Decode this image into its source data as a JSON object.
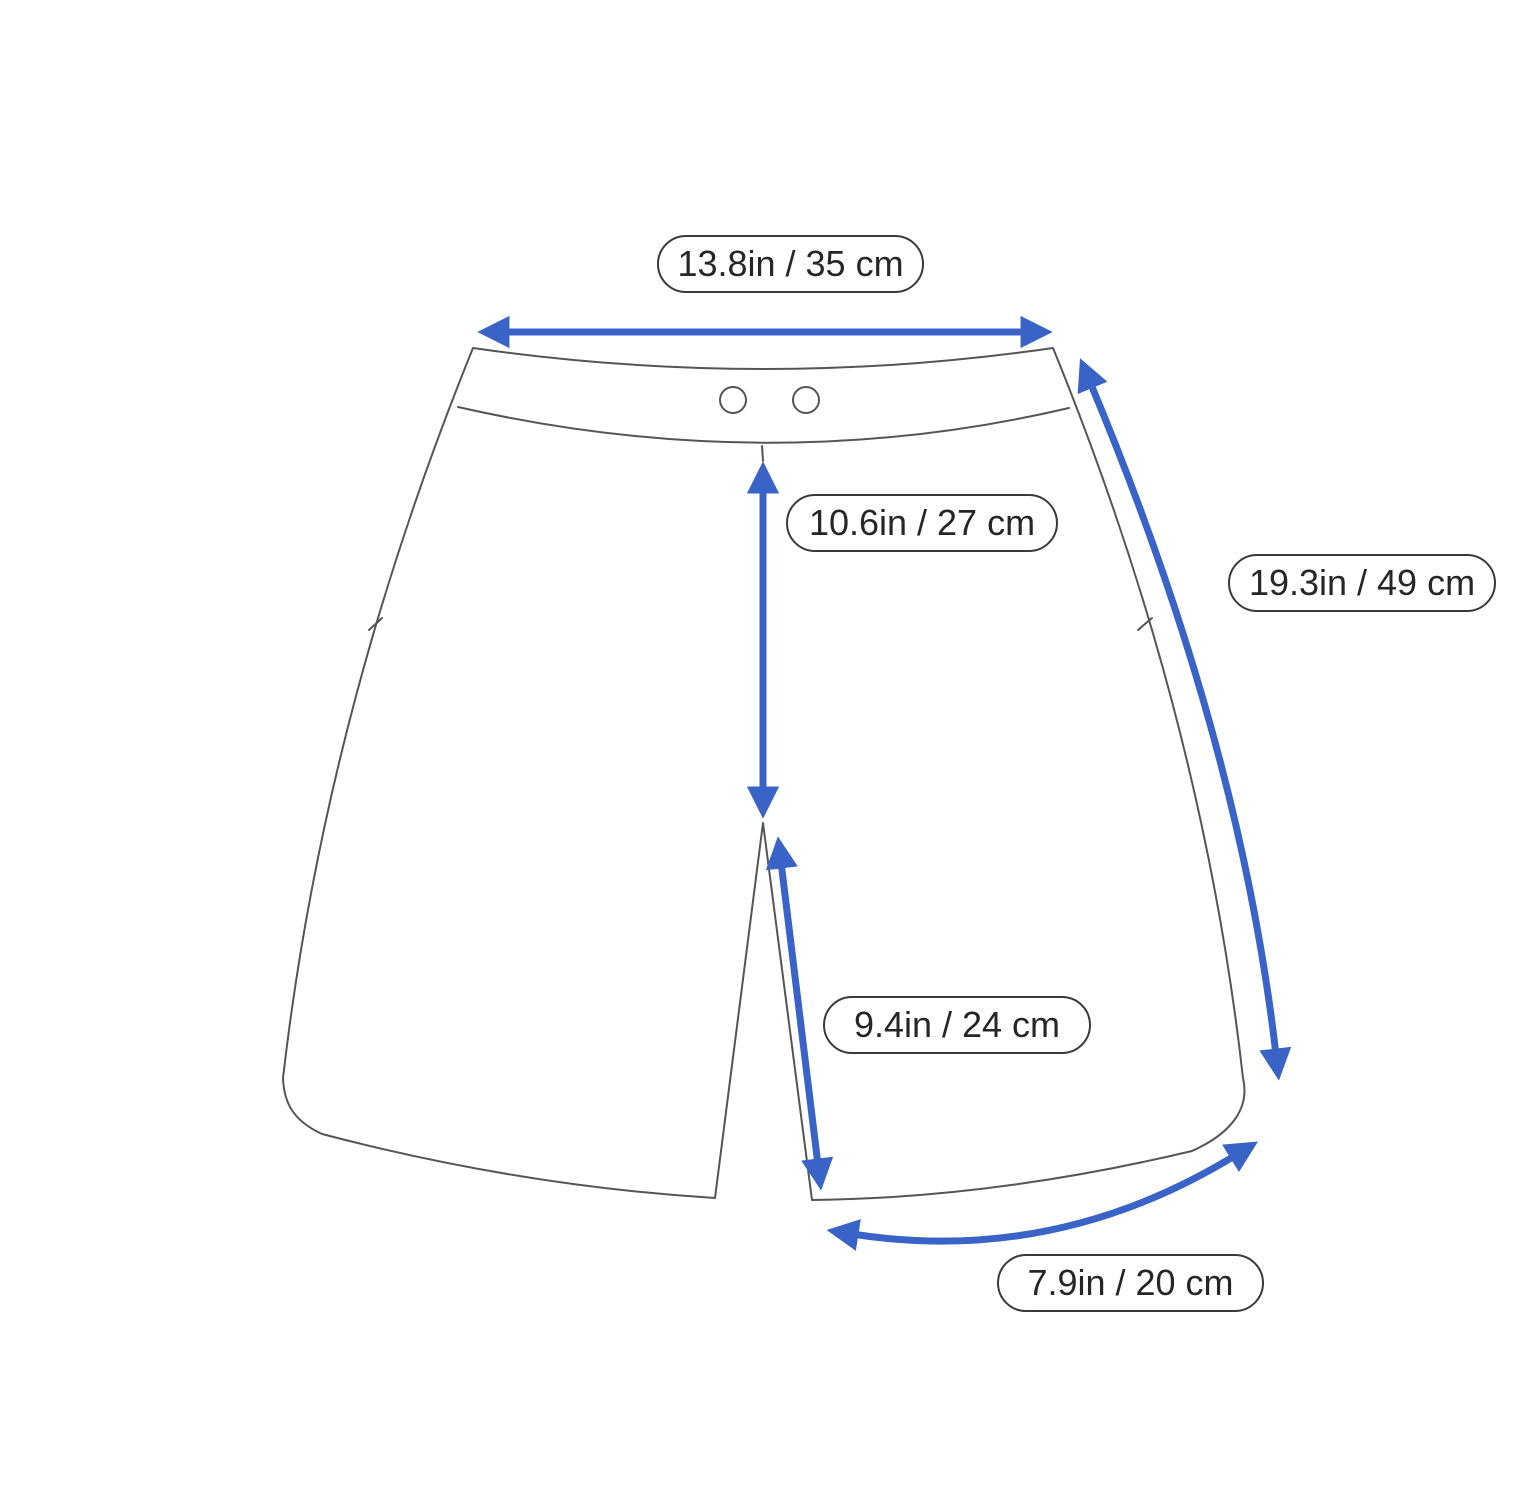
{
  "measurements": {
    "waist_width": "13.8in / 35 cm",
    "front_rise": "10.6in / 27 cm",
    "side_length": "19.3in / 49 cm",
    "inseam": "9.4in / 24 cm",
    "leg_opening": "7.9in / 20 cm"
  },
  "colors": {
    "arrow": "#3a63c8",
    "outline": "#555555",
    "pill-border": "#3a3a3a",
    "text": "#262626",
    "background": "#ffffff"
  },
  "icons": {
    "waist_width_arrow": "horizontal-double-arrow",
    "front_rise_arrow": "vertical-double-arrow",
    "side_length_arrow": "curved-double-arrow",
    "inseam_arrow": "diagonal-double-arrow",
    "leg_opening_arrow": "curved-double-arrow"
  }
}
